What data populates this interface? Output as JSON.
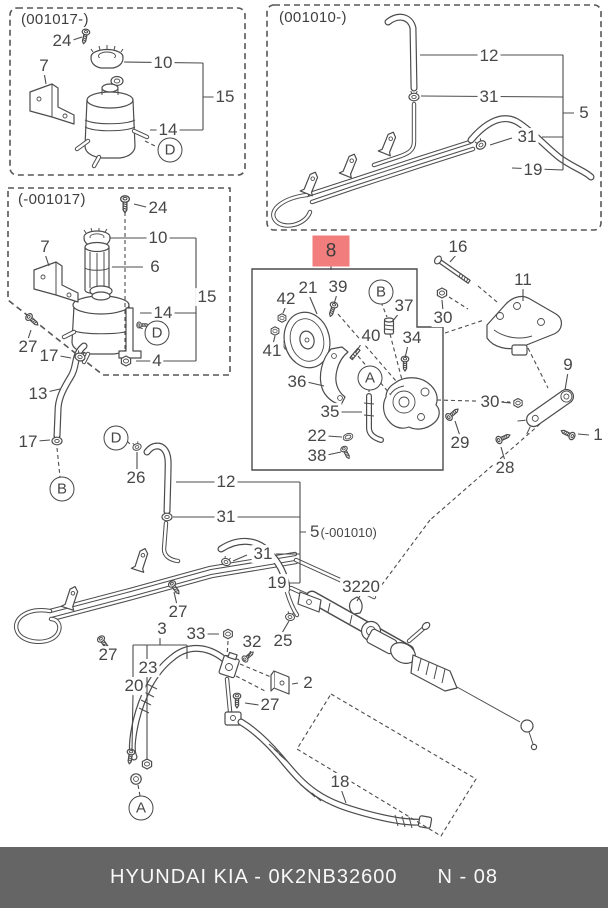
{
  "page": {
    "background": "#ffffff",
    "line_color": "#4c4c4c",
    "highlight_color": "#f27d7d",
    "footer_bg": "#656565",
    "footer_fg": "#f8f8f8"
  },
  "inset_boxes": [
    {
      "id": "variant-001017",
      "title": "(001017-)"
    },
    {
      "id": "variant-001010",
      "title": "(001010-)"
    },
    {
      "id": "variant-pre-001017",
      "title": "(-001017)"
    }
  ],
  "highlighted_part": {
    "label": "8"
  },
  "labels": [
    {
      "text": "24",
      "x": 62,
      "y": 41
    },
    {
      "text": "7",
      "x": 44,
      "y": 66
    },
    {
      "text": "10",
      "x": 163,
      "y": 63
    },
    {
      "text": "15",
      "x": 225,
      "y": 97
    },
    {
      "text": "14",
      "x": 168,
      "y": 130
    },
    {
      "text": "D",
      "x": 170,
      "y": 150,
      "circle": true
    },
    {
      "text": "12",
      "x": 489,
      "y": 56
    },
    {
      "text": "31",
      "x": 489,
      "y": 97
    },
    {
      "text": "5",
      "x": 584,
      "y": 113
    },
    {
      "text": "31",
      "x": 527,
      "y": 137
    },
    {
      "text": "19",
      "x": 533,
      "y": 170
    },
    {
      "text": "24",
      "x": 158,
      "y": 208
    },
    {
      "text": "10",
      "x": 158,
      "y": 238
    },
    {
      "text": "7",
      "x": 45,
      "y": 247
    },
    {
      "text": "6",
      "x": 155,
      "y": 267
    },
    {
      "text": "15",
      "x": 207,
      "y": 297
    },
    {
      "text": "14",
      "x": 163,
      "y": 313
    },
    {
      "text": "D",
      "x": 157,
      "y": 333,
      "circle": true
    },
    {
      "text": "27",
      "x": 28,
      "y": 347
    },
    {
      "text": "17",
      "x": 49,
      "y": 356
    },
    {
      "text": "4",
      "x": 157,
      "y": 361
    },
    {
      "text": "13",
      "x": 38,
      "y": 394
    },
    {
      "text": "17",
      "x": 28,
      "y": 442
    },
    {
      "text": "B",
      "x": 62,
      "y": 489,
      "circle": true
    },
    {
      "text": "8",
      "x": 331,
      "y": 251,
      "highlight": true
    },
    {
      "text": "21",
      "x": 308,
      "y": 288
    },
    {
      "text": "39",
      "x": 338,
      "y": 287
    },
    {
      "text": "42",
      "x": 286,
      "y": 299
    },
    {
      "text": "B",
      "x": 381,
      "y": 292,
      "circle": true
    },
    {
      "text": "37",
      "x": 404,
      "y": 306
    },
    {
      "text": "40",
      "x": 371,
      "y": 336
    },
    {
      "text": "34",
      "x": 412,
      "y": 338
    },
    {
      "text": "41",
      "x": 272,
      "y": 351
    },
    {
      "text": "36",
      "x": 297,
      "y": 382
    },
    {
      "text": "A",
      "x": 370,
      "y": 378,
      "circle": true
    },
    {
      "text": "35",
      "x": 330,
      "y": 412
    },
    {
      "text": "22",
      "x": 317,
      "y": 436
    },
    {
      "text": "38",
      "x": 317,
      "y": 456
    },
    {
      "text": "16",
      "x": 458,
      "y": 247
    },
    {
      "text": "30",
      "x": 443,
      "y": 318
    },
    {
      "text": "11",
      "x": 523,
      "y": 280
    },
    {
      "text": "9",
      "x": 568,
      "y": 365
    },
    {
      "text": "30",
      "x": 490,
      "y": 402
    },
    {
      "text": "29",
      "x": 460,
      "y": 443
    },
    {
      "text": "1",
      "x": 598,
      "y": 435
    },
    {
      "text": "28",
      "x": 505,
      "y": 468
    },
    {
      "text": "D",
      "x": 116,
      "y": 438,
      "circle": true
    },
    {
      "text": "26",
      "x": 136,
      "y": 478
    },
    {
      "text": "12",
      "x": 226,
      "y": 482
    },
    {
      "text": "31",
      "x": 226,
      "y": 517
    },
    {
      "text": "5",
      "x": 308,
      "y": 532,
      "suffix": "(-001010)",
      "anchor": "left"
    },
    {
      "text": "31",
      "x": 263,
      "y": 554
    },
    {
      "text": "19",
      "x": 277,
      "y": 583
    },
    {
      "text": "3220",
      "x": 361,
      "y": 587
    },
    {
      "text": "27",
      "x": 178,
      "y": 612
    },
    {
      "text": "3",
      "x": 162,
      "y": 629
    },
    {
      "text": "33",
      "x": 196,
      "y": 634
    },
    {
      "text": "32",
      "x": 252,
      "y": 642
    },
    {
      "text": "25",
      "x": 283,
      "y": 641
    },
    {
      "text": "27",
      "x": 108,
      "y": 655
    },
    {
      "text": "23",
      "x": 148,
      "y": 668
    },
    {
      "text": "20",
      "x": 134,
      "y": 686
    },
    {
      "text": "2",
      "x": 308,
      "y": 683
    },
    {
      "text": "27",
      "x": 270,
      "y": 705
    },
    {
      "text": "18",
      "x": 340,
      "y": 782
    },
    {
      "text": "A",
      "x": 141,
      "y": 808,
      "circle": true
    }
  ],
  "footer": {
    "left": "HYUNDAI  KIA - 0K2NB32600",
    "right": "N - 08"
  }
}
